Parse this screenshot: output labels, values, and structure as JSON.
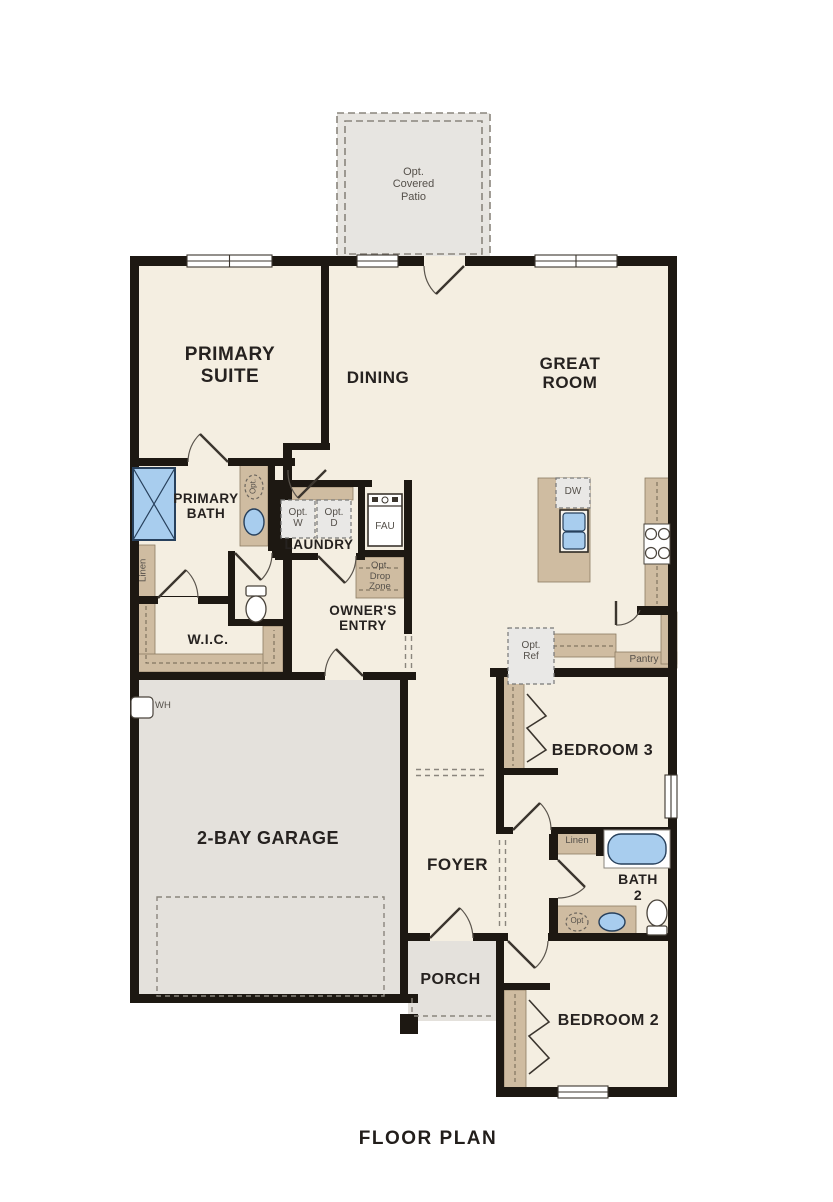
{
  "page_title": "FLOOR PLAN",
  "colors": {
    "wall": "#1d1812",
    "room_fill": "#f4eee1",
    "garage_fill": "#e4e1dc",
    "patio_fill": "#e7e5e1",
    "cabinet_tan": "#cfbca1",
    "fixture_blue": "#a8cdee",
    "fixture_blue_dark": "#27405c",
    "optional_gray": "#e9e8e6",
    "label_dark": "#262220",
    "label_gray": "#55504a"
  },
  "rooms": {
    "patio": "Opt.\nCovered\nPatio",
    "primary_suite": "PRIMARY\nSUITE",
    "dining": "DINING",
    "great_room": "GREAT\nROOM",
    "primary_bath": "PRIMARY\nBATH",
    "laundry": "LAUNDRY",
    "owners_entry": "OWNER'S\nENTRY",
    "wic": "W.I.C.",
    "garage": "2-BAY GARAGE",
    "foyer": "FOYER",
    "bedroom3": "BEDROOM 3",
    "bath2": "BATH\n2",
    "bedroom2": "BEDROOM 2",
    "porch": "PORCH"
  },
  "fixtures": {
    "washer": "Opt.\nW",
    "dryer": "Opt.\nD",
    "fau": "FAU",
    "drop_zone": "Opt.\nDrop\nZone",
    "linen_primary": "Linen",
    "linen_bath2": "Linen",
    "water_heater": "WH",
    "dishwasher": "DW",
    "pantry": "Pantry",
    "fridge": "Opt.\nRef",
    "opt_sink_primary": "Opt.",
    "opt_sink_bath2": "Opt"
  }
}
